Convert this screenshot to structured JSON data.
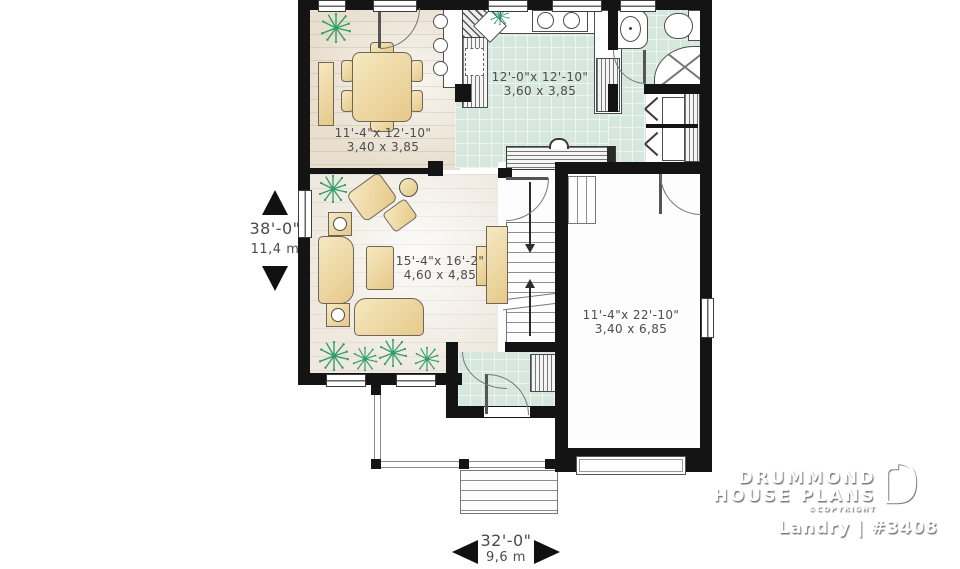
{
  "plan": {
    "rooms": {
      "dining": {
        "imperial": "11'-4\"x 12'-10\"",
        "metric": "3,40 x 3,85"
      },
      "kitchen": {
        "imperial": "12'-0\"x 12'-10\"",
        "metric": "3,60 x 3,85"
      },
      "living": {
        "imperial": "15'-4\"x 16'-2\"",
        "metric": "4,60 x 4,85"
      },
      "garage": {
        "imperial": "11'-4\"x 22'-10\"",
        "metric": "3,40 x 6,85"
      }
    },
    "dimensions": {
      "depth": {
        "imperial": "38'-0\"",
        "metric": "11,4 m"
      },
      "width": {
        "imperial": "32'-0\"",
        "metric": "9,6 m"
      }
    }
  },
  "branding": {
    "name_line1": "DRUMMOND",
    "name_line2": "HOUSE PLANS",
    "copyright": "©COPYRIGHT",
    "plan_label": "Landry | #3408"
  },
  "colors": {
    "wall": "#141414",
    "tile_floor": "#d6e7dd",
    "wood_floor": "#e8dfcf",
    "living_floor": "#eee8de",
    "furniture": "#ecd69e",
    "plant": "#2f9e68",
    "dimension_text": "#4b4b4b",
    "logo_text": "#ffffff"
  }
}
